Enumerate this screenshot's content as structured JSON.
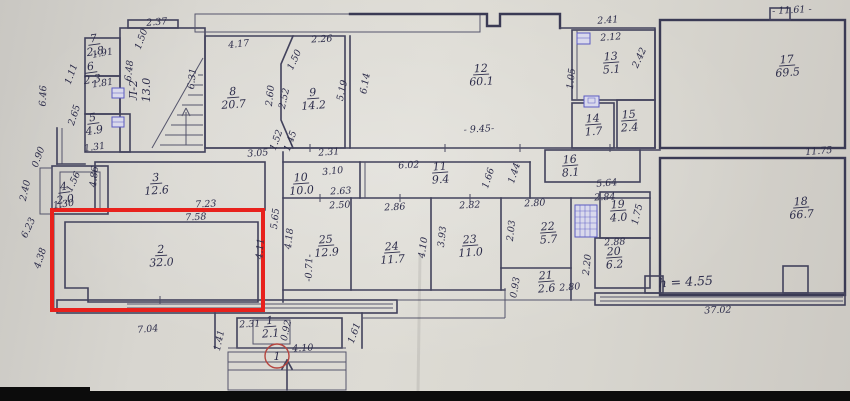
{
  "scene": {
    "kind": "scanned floor plan photo",
    "highlighted_room": "2"
  },
  "colors": {
    "paper": "#d8d6d0",
    "ink": "#42425c",
    "highlight_red": "#e8211c",
    "annotation_blue": "#4444c0",
    "entrance_red": "#b5453f",
    "photo_black": "#0c0c0c"
  },
  "rooms": [
    {
      "number": "1",
      "area": "2.1",
      "x": 270,
      "y": 324,
      "rot": -4
    },
    {
      "number": "2",
      "area": "32.0",
      "x": 161,
      "y": 253,
      "rot": -3
    },
    {
      "number": "3",
      "area": "12.6",
      "x": 156,
      "y": 181,
      "rot": -4
    },
    {
      "number": "4",
      "area": "2.0",
      "x": 64,
      "y": 190,
      "rot": -8
    },
    {
      "number": "5",
      "area": "4.9",
      "x": 93,
      "y": 121,
      "rot": -8
    },
    {
      "number": "6",
      "area": "2.3",
      "x": 91,
      "y": 70,
      "rot": -8
    },
    {
      "number": "7",
      "area": "2.8",
      "x": 94,
      "y": 42,
      "rot": -8
    },
    {
      "number": "8",
      "area": "20.7",
      "x": 233,
      "y": 95,
      "rot": -4
    },
    {
      "number": "9",
      "area": "14.2",
      "x": 313,
      "y": 96,
      "rot": -4
    },
    {
      "number": "10",
      "area": "10.0",
      "x": 301,
      "y": 181,
      "rot": -4
    },
    {
      "number": "11",
      "area": "9.4",
      "x": 440,
      "y": 170,
      "rot": -4
    },
    {
      "number": "12",
      "area": "60.1",
      "x": 481,
      "y": 72,
      "rot": -3
    },
    {
      "number": "13",
      "area": "5.1",
      "x": 611,
      "y": 60,
      "rot": -4
    },
    {
      "number": "14",
      "area": "1.7",
      "x": 593,
      "y": 122,
      "rot": -4
    },
    {
      "number": "15",
      "area": "2.4",
      "x": 629,
      "y": 118,
      "rot": -4
    },
    {
      "number": "16",
      "area": "8.1",
      "x": 570,
      "y": 163,
      "rot": -4
    },
    {
      "number": "17",
      "area": "69.5",
      "x": 787,
      "y": 63,
      "rot": -4
    },
    {
      "number": "18",
      "area": "66.7",
      "x": 801,
      "y": 205,
      "rot": -4
    },
    {
      "number": "19",
      "area": "4.0",
      "x": 618,
      "y": 208,
      "rot": -4
    },
    {
      "number": "20",
      "area": "6.2",
      "x": 614,
      "y": 255,
      "rot": -4
    },
    {
      "number": "21",
      "area": "2.6",
      "x": 546,
      "y": 279,
      "rot": -4
    },
    {
      "number": "22",
      "area": "5.7",
      "x": 548,
      "y": 230,
      "rot": -4
    },
    {
      "number": "23",
      "area": "11.0",
      "x": 470,
      "y": 243,
      "rot": -4
    },
    {
      "number": "24",
      "area": "11.7",
      "x": 392,
      "y": 250,
      "rot": -4
    },
    {
      "number": "25",
      "area": "12.9",
      "x": 326,
      "y": 243,
      "rot": -4
    }
  ],
  "dimensions": [
    {
      "text": "6.46",
      "x": 46,
      "y": 96,
      "rot": -88
    },
    {
      "text": "0.90",
      "x": 41,
      "y": 158,
      "rot": -70
    },
    {
      "text": "2.40",
      "x": 28,
      "y": 191,
      "rot": -78
    },
    {
      "text": "1.31",
      "x": 95,
      "y": 150,
      "rot": -8
    },
    {
      "text": "1.56",
      "x": 76,
      "y": 183,
      "rot": -65
    },
    {
      "text": "1.30",
      "x": 64,
      "y": 207,
      "rot": -8
    },
    {
      "text": "4.86",
      "x": 97,
      "y": 177,
      "rot": -84
    },
    {
      "text": "6.23",
      "x": 31,
      "y": 229,
      "rot": -65
    },
    {
      "text": "4.38",
      "x": 43,
      "y": 259,
      "rot": -72
    },
    {
      "text": "1.50",
      "x": 144,
      "y": 40,
      "rot": -70
    },
    {
      "text": "1.91",
      "x": 103,
      "y": 56,
      "rot": -10
    },
    {
      "text": "1.11",
      "x": 74,
      "y": 75,
      "rot": -70
    },
    {
      "text": "1.81",
      "x": 103,
      "y": 86,
      "rot": -8
    },
    {
      "text": "2.65",
      "x": 77,
      "y": 116,
      "rot": -72
    },
    {
      "text": "2.37",
      "x": 157,
      "y": 25,
      "rot": -5
    },
    {
      "text": "6.48",
      "x": 132,
      "y": 71,
      "rot": -84
    },
    {
      "text": "6.31",
      "x": 195,
      "y": 79,
      "rot": -84
    },
    {
      "text": "4.17",
      "x": 239,
      "y": 47,
      "rot": -6
    },
    {
      "text": "2.26",
      "x": 322,
      "y": 42,
      "rot": -3
    },
    {
      "text": "1.50",
      "x": 297,
      "y": 61,
      "rot": -65
    },
    {
      "text": "2.60",
      "x": 273,
      "y": 96,
      "rot": -84
    },
    {
      "text": "2.52",
      "x": 287,
      "y": 99,
      "rot": -78
    },
    {
      "text": "1.52",
      "x": 279,
      "y": 141,
      "rot": -70
    },
    {
      "text": "1.45",
      "x": 293,
      "y": 142,
      "rot": -70
    },
    {
      "text": "3.05",
      "x": 258,
      "y": 156,
      "rot": -4
    },
    {
      "text": "2.31",
      "x": 329,
      "y": 155,
      "rot": -4
    },
    {
      "text": "5.19",
      "x": 345,
      "y": 91,
      "rot": -78
    },
    {
      "text": "6.14",
      "x": 368,
      "y": 84,
      "rot": -80
    },
    {
      "text": "- 9.45-",
      "x": 479,
      "y": 132,
      "rot": -3
    },
    {
      "text": "2.41",
      "x": 608,
      "y": 23,
      "rot": -4
    },
    {
      "text": "2.12",
      "x": 611,
      "y": 40,
      "rot": -4
    },
    {
      "text": "1.05",
      "x": 574,
      "y": 79,
      "rot": -84
    },
    {
      "text": "2.42",
      "x": 642,
      "y": 59,
      "rot": -65
    },
    {
      "text": "- 11.61 -",
      "x": 792,
      "y": 13,
      "rot": -3
    },
    {
      "text": "11.75",
      "x": 819,
      "y": 154,
      "rot": -5
    },
    {
      "text": "3.10",
      "x": 333,
      "y": 174,
      "rot": -6
    },
    {
      "text": "2.63",
      "x": 341,
      "y": 194,
      "rot": -3
    },
    {
      "text": "6.02",
      "x": 409,
      "y": 168,
      "rot": -3
    },
    {
      "text": "1.66",
      "x": 491,
      "y": 179,
      "rot": -72
    },
    {
      "text": "1.44",
      "x": 517,
      "y": 174,
      "rot": -72
    },
    {
      "text": "5.64",
      "x": 607,
      "y": 186,
      "rot": -5
    },
    {
      "text": "7.23",
      "x": 206,
      "y": 207,
      "rot": -3
    },
    {
      "text": "7.58",
      "x": 196,
      "y": 220,
      "rot": -3
    },
    {
      "text": "2.50",
      "x": 340,
      "y": 208,
      "rot": -3
    },
    {
      "text": "2.86",
      "x": 395,
      "y": 210,
      "rot": -3
    },
    {
      "text": "2.82",
      "x": 470,
      "y": 208,
      "rot": -3
    },
    {
      "text": "2.80",
      "x": 535,
      "y": 206,
      "rot": -3
    },
    {
      "text": "2.84",
      "x": 605,
      "y": 200,
      "rot": -3
    },
    {
      "text": "2.88",
      "x": 615,
      "y": 245,
      "rot": -3
    },
    {
      "text": "5.65",
      "x": 278,
      "y": 219,
      "rot": -84
    },
    {
      "text": "4.18",
      "x": 292,
      "y": 239,
      "rot": -84
    },
    {
      "text": "4.11",
      "x": 263,
      "y": 249,
      "rot": -85
    },
    {
      "text": "-0.71-",
      "x": 312,
      "y": 268,
      "rot": -88
    },
    {
      "text": "4.10",
      "x": 426,
      "y": 248,
      "rot": -82
    },
    {
      "text": "3.93",
      "x": 445,
      "y": 237,
      "rot": -84
    },
    {
      "text": "2.03",
      "x": 514,
      "y": 231,
      "rot": -84
    },
    {
      "text": "1.75",
      "x": 640,
      "y": 215,
      "rot": -76
    },
    {
      "text": "2.20",
      "x": 590,
      "y": 265,
      "rot": -84
    },
    {
      "text": "0.93",
      "x": 518,
      "y": 288,
      "rot": -80
    },
    {
      "text": "2.80",
      "x": 570,
      "y": 290,
      "rot": -4
    },
    {
      "text": "7.04",
      "x": 148,
      "y": 332,
      "rot": -5
    },
    {
      "text": "37.02",
      "x": 718,
      "y": 313,
      "rot": -2
    },
    {
      "text": "2.31",
      "x": 250,
      "y": 327,
      "rot": -3
    },
    {
      "text": "0.92",
      "x": 289,
      "y": 331,
      "rot": -78
    },
    {
      "text": "1.41",
      "x": 222,
      "y": 341,
      "rot": -78
    },
    {
      "text": "1.61",
      "x": 357,
      "y": 334,
      "rot": -70
    },
    {
      "text": "4.10",
      "x": 303,
      "y": 351,
      "rot": -3
    }
  ],
  "annotations": {
    "height_note": "h = 4.55",
    "entrance_number": "1",
    "stair_label": "Л-2",
    "stair_area": "13.0"
  }
}
